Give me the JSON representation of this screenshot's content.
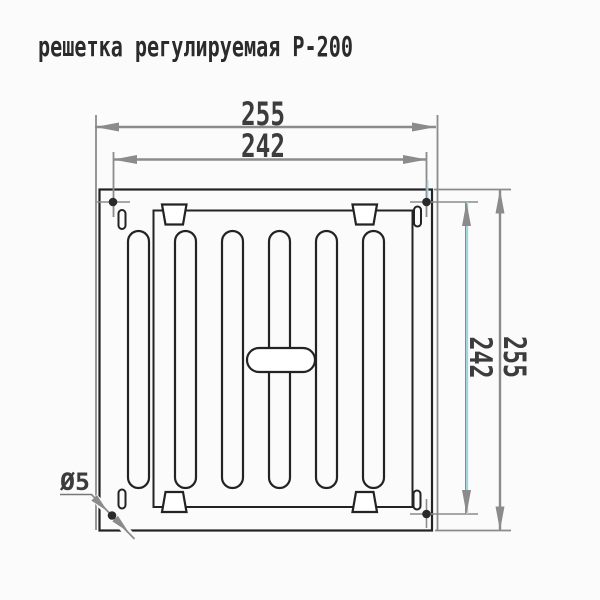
{
  "title": "решетка регулируемая Р-200",
  "dimensions": {
    "outer_width": "255",
    "inner_width": "242",
    "outer_height": "255",
    "inner_height": "242",
    "hole_diameter": "Ø5"
  },
  "colors": {
    "background": "#fbfbfb",
    "drawing_line": "#232323",
    "dimension_line": "#8b8b8b",
    "accent_dimension_line": "#9cd6e6",
    "label_text": "#3c3c3c"
  }
}
